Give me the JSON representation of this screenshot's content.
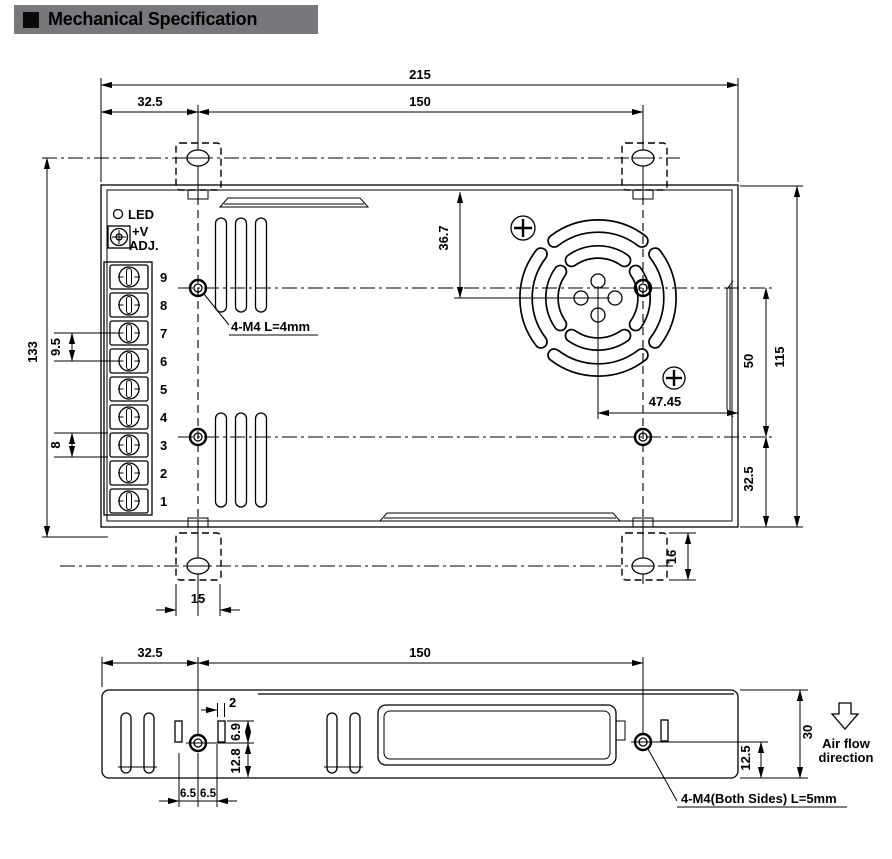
{
  "title": {
    "text": "Mechanical Specification"
  },
  "colors": {
    "title_bg": "#77787b",
    "line": "#000000",
    "background": "#ffffff"
  },
  "top_view": {
    "d215": "215",
    "d32_5": "32.5",
    "d150": "150",
    "d133": "133",
    "d9_5": "9.5",
    "d8": "8",
    "d36_7": "36.7",
    "d47_45": "47.45",
    "d50": "50",
    "d115": "115",
    "d32_5b": "32.5",
    "d15": "15",
    "d16": "16",
    "led": "LED",
    "vplus": "+V",
    "adj": "ADJ.",
    "note": "4-M4 L=4mm",
    "terminals": [
      "9",
      "8",
      "7",
      "6",
      "5",
      "4",
      "3",
      "2",
      "1"
    ]
  },
  "side_view": {
    "d32_5": "32.5",
    "d150": "150",
    "d2": "2",
    "d6_9": "6.9",
    "d12_8": "12.8",
    "d6_5a": "6.5",
    "d6_5b": "6.5",
    "d12_5": "12.5",
    "d30": "30",
    "note": "4-M4(Both Sides) L=5mm",
    "air1": "Air flow",
    "air2": "direction"
  }
}
